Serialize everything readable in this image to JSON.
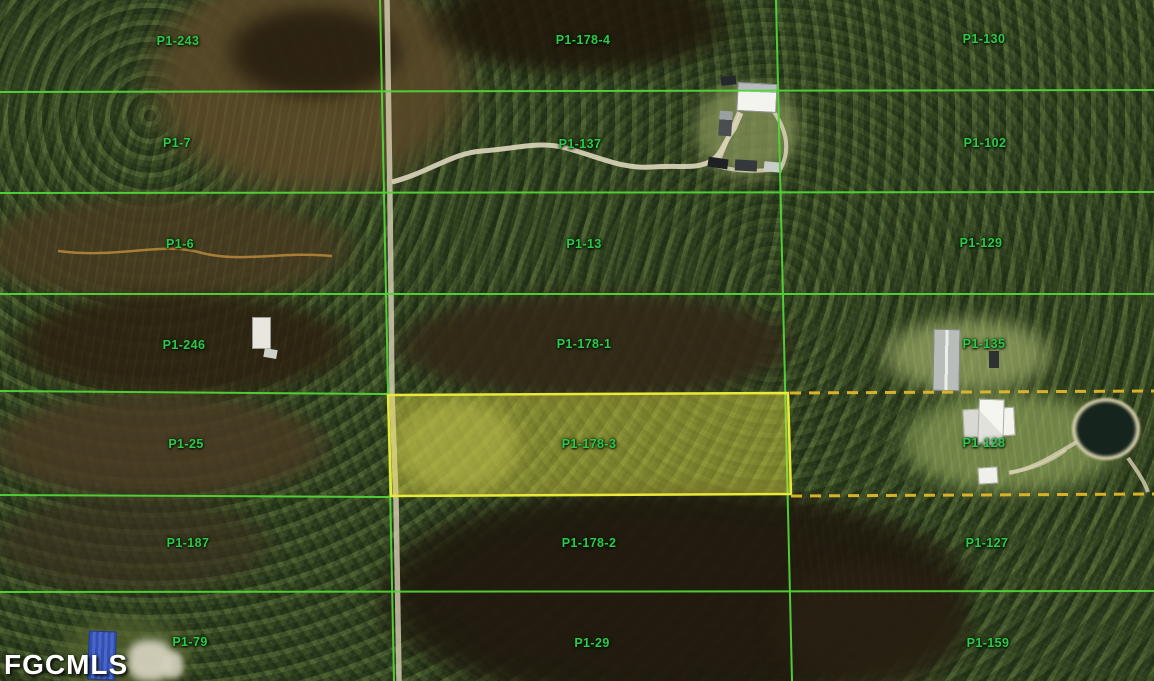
{
  "watermark": {
    "text": "FGCMLS"
  },
  "map": {
    "highlighted_parcel": "P1-178-3",
    "overlay_colors": {
      "grid_green": "#52d437",
      "highlight_border": "#e9e93a",
      "highlight_fill": "rgba(230,225,70,0.42)",
      "dashed_gold": "#e0b82a",
      "label_green": "#2fc84a"
    },
    "parcels": [
      {
        "label": "P1-243",
        "x": 178,
        "y": 41
      },
      {
        "label": "P1-178-4",
        "x": 583,
        "y": 40
      },
      {
        "label": "P1-130",
        "x": 984,
        "y": 39
      },
      {
        "label": "P1-7",
        "x": 177,
        "y": 143
      },
      {
        "label": "P1-137",
        "x": 580,
        "y": 144
      },
      {
        "label": "P1-102",
        "x": 985,
        "y": 143
      },
      {
        "label": "P1-6",
        "x": 180,
        "y": 244
      },
      {
        "label": "P1-13",
        "x": 584,
        "y": 244
      },
      {
        "label": "P1-129",
        "x": 981,
        "y": 243
      },
      {
        "label": "P1-246",
        "x": 184,
        "y": 345
      },
      {
        "label": "P1-178-1",
        "x": 584,
        "y": 344
      },
      {
        "label": "P1-135",
        "x": 984,
        "y": 344
      },
      {
        "label": "P1-25",
        "x": 186,
        "y": 444
      },
      {
        "label": "P1-178-3",
        "x": 589,
        "y": 444,
        "highlighted": true
      },
      {
        "label": "P1-128",
        "x": 984,
        "y": 443
      },
      {
        "label": "P1-187",
        "x": 188,
        "y": 543
      },
      {
        "label": "P1-178-2",
        "x": 589,
        "y": 543
      },
      {
        "label": "P1-127",
        "x": 987,
        "y": 543
      },
      {
        "label": "P1-79",
        "x": 190,
        "y": 642
      },
      {
        "label": "P1-29",
        "x": 592,
        "y": 643
      },
      {
        "label": "P1-159",
        "x": 988,
        "y": 643
      }
    ]
  }
}
